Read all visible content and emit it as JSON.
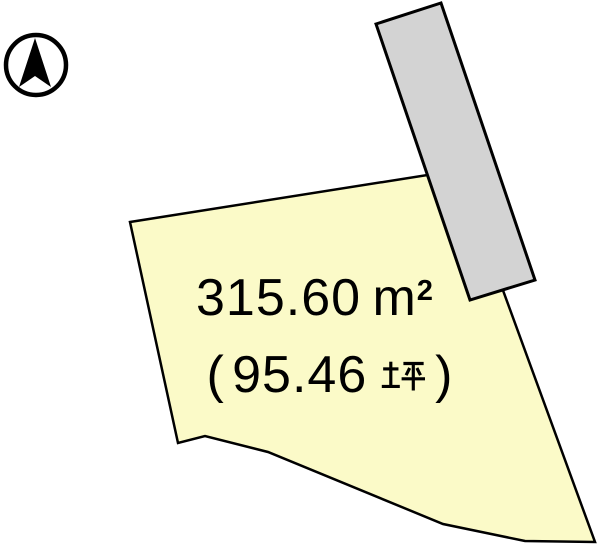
{
  "page": {
    "width": 600,
    "height": 545,
    "background": "#ffffff",
    "type_hint": "land-plot-survey-diagram"
  },
  "colors": {
    "plot_fill": "#FBFAC8",
    "road_fill": "#D3D3D3",
    "outline": "#000000"
  },
  "icons": {
    "north_arrow": "compass-north-arrow-icon"
  },
  "plot_label": {
    "area_value": "315.60",
    "area_unit_base": "m",
    "area_unit_exponent": "2",
    "area_text_full": "315.60 ㎡",
    "tsubo_open_paren": "(",
    "tsubo_value": "95.46",
    "tsubo_unit": "坪",
    "tsubo_close_paren": ")",
    "tsubo_text_full": "（95.46 坪）"
  }
}
